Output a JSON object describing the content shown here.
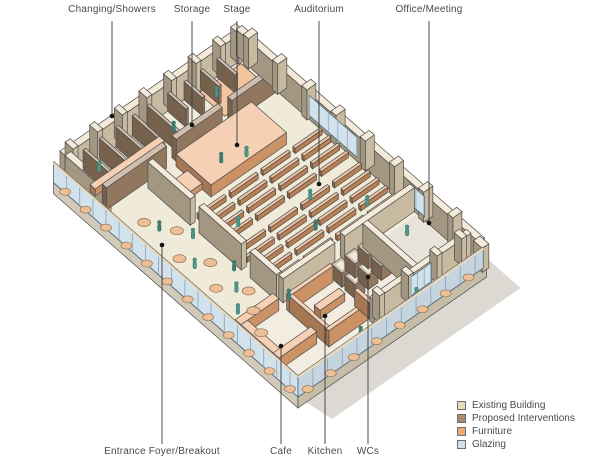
{
  "diagram": {
    "type": "axonometric-floor-plan",
    "subject": "community hall cutaway plan with annotated rooms"
  },
  "labels": {
    "top": [
      {
        "text": "Changing/Showers"
      },
      {
        "text": "Storage"
      },
      {
        "text": "Stage"
      },
      {
        "text": "Auditorium"
      },
      {
        "text": "Office/Meeting"
      }
    ],
    "bottom": [
      {
        "text": "Entrance Foyer/Breakout"
      },
      {
        "text": "Cafe"
      },
      {
        "text": "Kitchen"
      },
      {
        "text": "WCs"
      }
    ]
  },
  "legend": {
    "items": [
      {
        "label": "Existing Building",
        "color_key": "existing"
      },
      {
        "label": "Proposed Interventions",
        "color_key": "proposed"
      },
      {
        "label": "Furniture",
        "color_key": "furniture"
      },
      {
        "label": "Glazing",
        "color_key": "glazing"
      }
    ]
  },
  "colors": {
    "existing": "#e9d8ba",
    "proposed": "#a98a6c",
    "furniture": "#ecaa76",
    "glazing": "#d2e2ec",
    "floor": "#f2ede0",
    "floor_inner": "#f0ead9",
    "slab_side": "#d2cab8",
    "slab_side_dark": "#c6bda9",
    "shadow": "#dcd9d2",
    "people": "#4e9a8c",
    "table": "#ecbf97",
    "outline": "#4d4d4d",
    "leader": "#3a3a3a",
    "text": "#4a4a4a"
  }
}
